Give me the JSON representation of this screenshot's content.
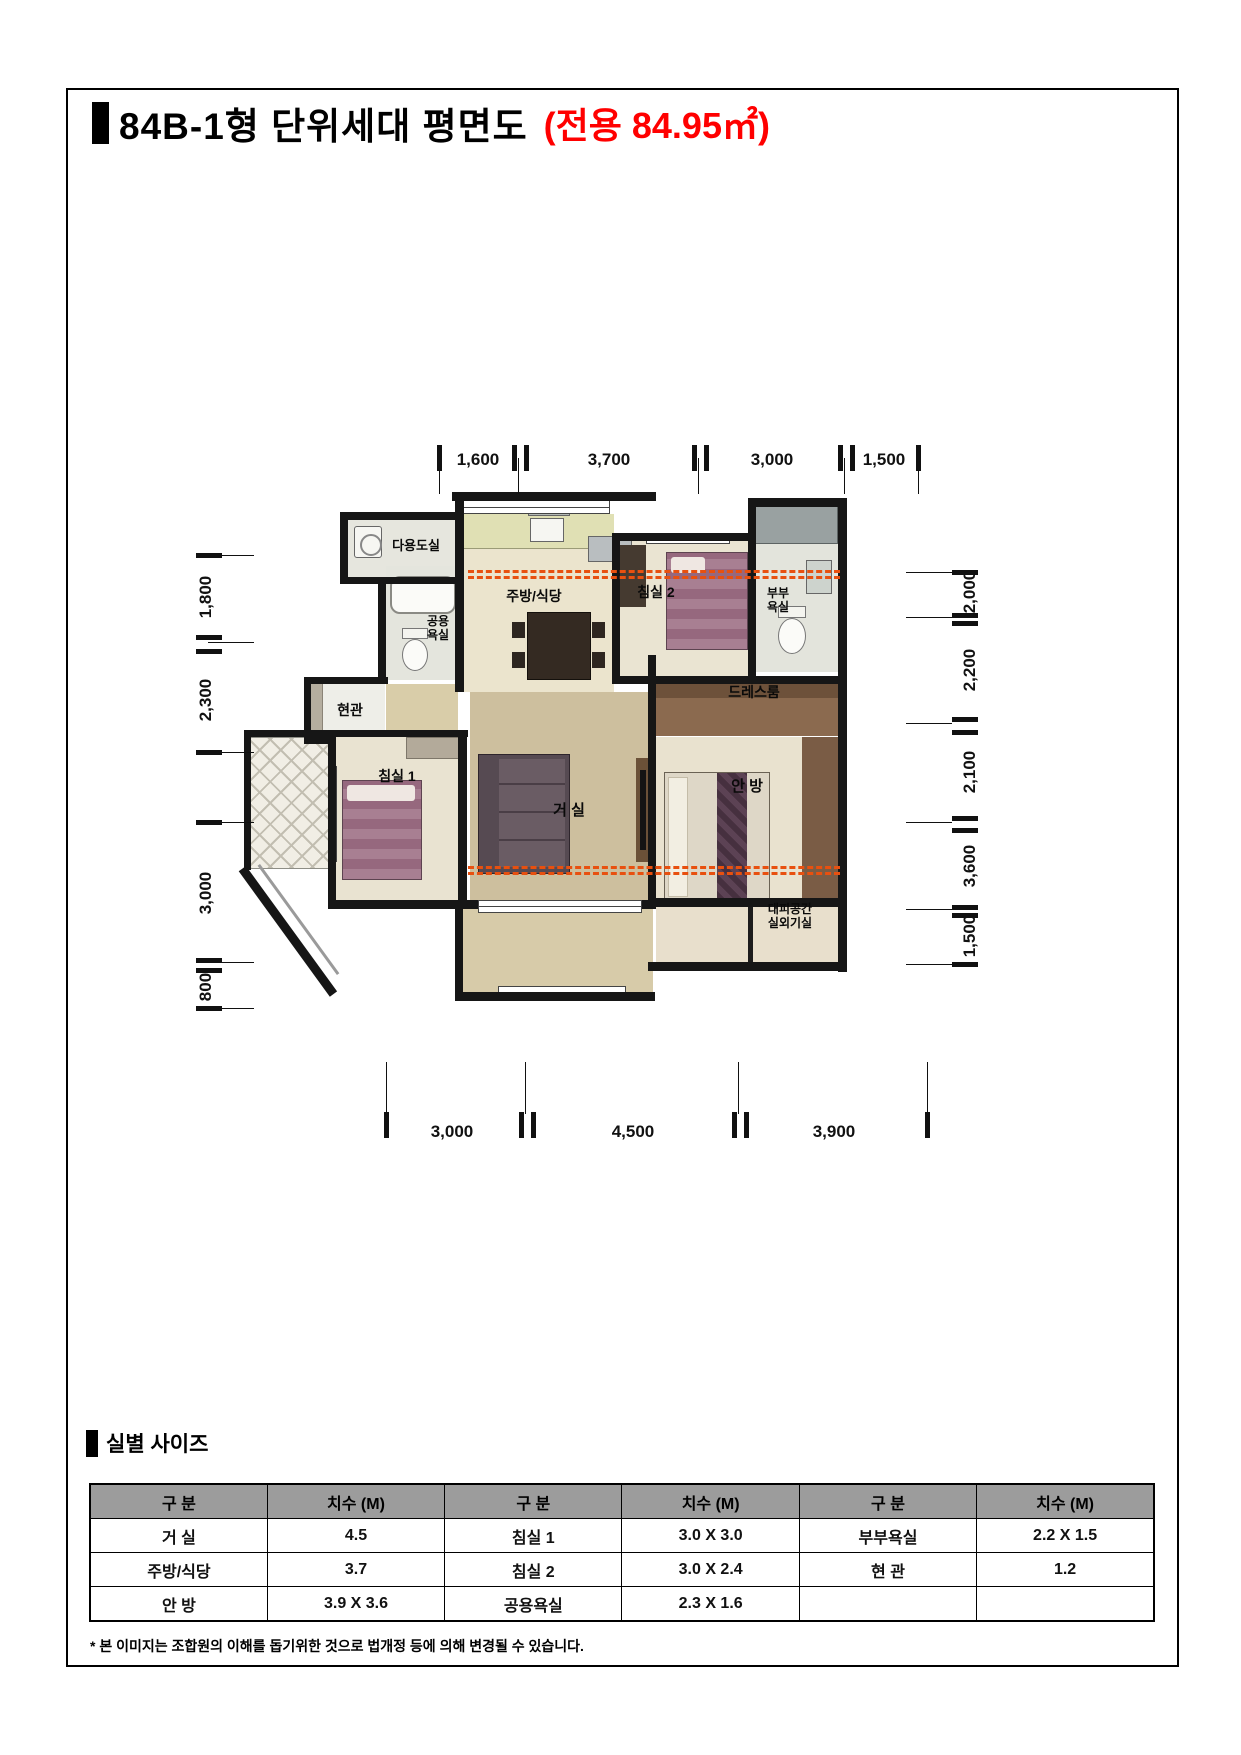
{
  "title": {
    "main": "84B-1형 단위세대 평면도",
    "area": "(전용 84.95㎡)"
  },
  "section": {
    "heading": "실별 사이즈"
  },
  "footnote": "* 본 이미지는 조합원의 이해를 돕기위한 것으로 법개정 등에 의해 변경될 수 있습니다.",
  "colors": {
    "accent_red": "#ff0000",
    "wall_black": "#161616",
    "table_header_gray": "#9c9c9c",
    "section_line_orange": "#e8500f"
  },
  "floor_plan": {
    "rooms": {
      "utility": "다용도실",
      "kitchen": "주방/식당",
      "bedroom2": "침실 2",
      "master_bath": [
        "부부",
        "욕실"
      ],
      "common_bath": [
        "공용",
        "욕실"
      ],
      "entrance": "현관",
      "dressroom": "드레스룸",
      "bedroom1": "침실 1",
      "living": "거 실",
      "master_bedroom": "안 방",
      "refuge": [
        "대피공간",
        "실외기실"
      ]
    },
    "dims": {
      "top": [
        "1,600",
        "3,700",
        "3,000",
        "1,500"
      ],
      "bottom": [
        "3,000",
        "4,500",
        "3,900"
      ],
      "left": [
        "1,800",
        "2,300",
        "3,000",
        "800"
      ],
      "right": [
        "2,000",
        "2,200",
        "2,100",
        "3,600",
        "1,500"
      ]
    },
    "icons": [
      "washing-machine",
      "range-hood",
      "stove",
      "sink",
      "bathtub",
      "toilet",
      "bed",
      "sofa",
      "tv",
      "dining-table",
      "wardrobe",
      "shoe-cabinet"
    ]
  },
  "size_table": {
    "headers": [
      "구 분",
      "치수 (M)",
      "구 분",
      "치수 (M)",
      "구 분",
      "치수 (M)"
    ],
    "rows": [
      [
        "거 실",
        "4.5",
        "침실 1",
        "3.0 X 3.0",
        "부부욕실",
        "2.2 X 1.5"
      ],
      [
        "주방/식당",
        "3.7",
        "침실 2",
        "3.0 X 2.4",
        "현 관",
        "1.2"
      ],
      [
        "안 방",
        "3.9 X 3.6",
        "공용욕실",
        "2.3 X 1.6",
        "",
        ""
      ]
    ]
  }
}
